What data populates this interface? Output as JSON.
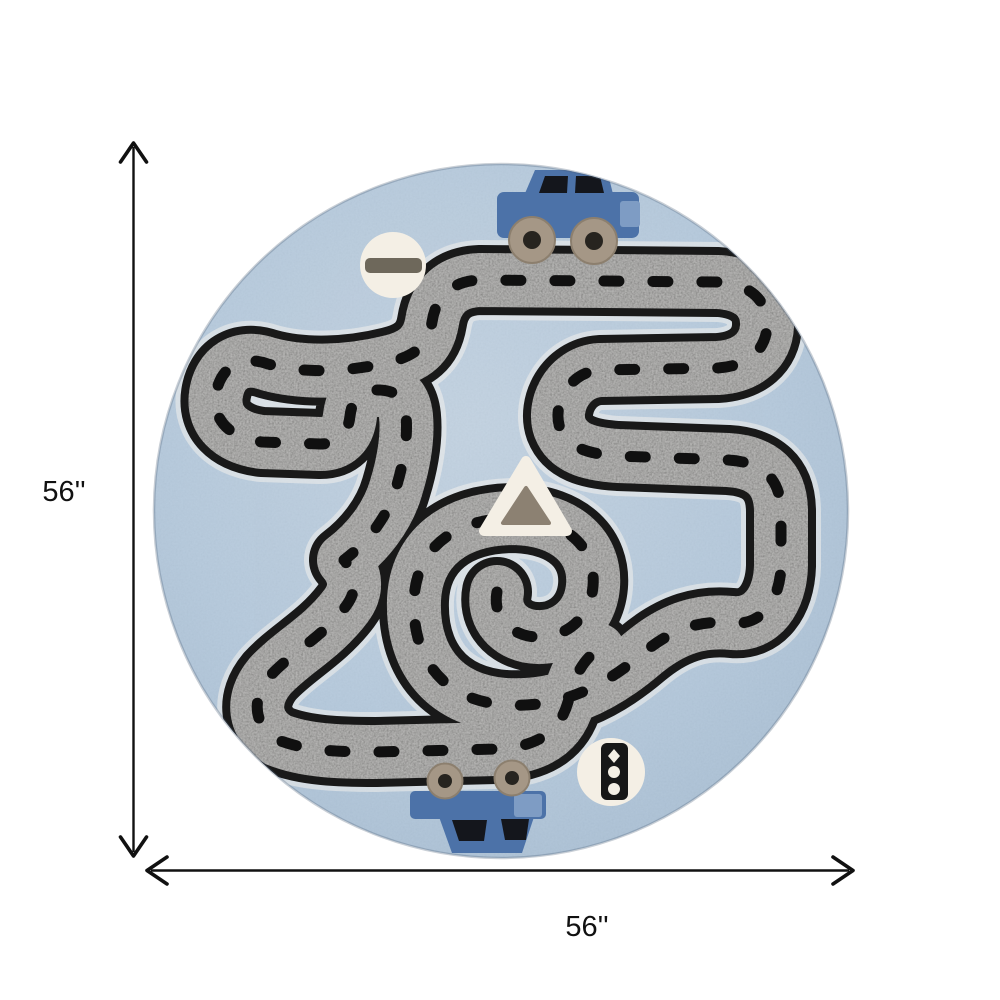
{
  "figure": {
    "type": "product-dimension-image",
    "background_color": "#ffffff"
  },
  "dimension_annotation": {
    "height_label": "56''",
    "width_label": "56''",
    "line_color": "#111111"
  },
  "rug": {
    "shape": "round",
    "base_color": "#b5c9dc",
    "road_color": "#8e8d8a",
    "road_edge_color": "#191919",
    "road_dash_color": "#101010",
    "road_halo_color": "#f2f1ec",
    "car_color": "#4c72a8",
    "car_accent_color": "#7e9cc4",
    "car_window_color": "#14161c",
    "wheel_color": "#a59786",
    "wheel_hub_color": "#27241f",
    "sign_color": "#f4efe5",
    "sign_bar_color": "#6e685b",
    "triangle_color": "#8c8172",
    "traffic_light_color": "#171717",
    "icons": [
      "top-car-icon",
      "no-entry-sign-icon",
      "warning-triangle-icon",
      "traffic-light-icon",
      "bottom-car-icon",
      "road-track"
    ]
  }
}
